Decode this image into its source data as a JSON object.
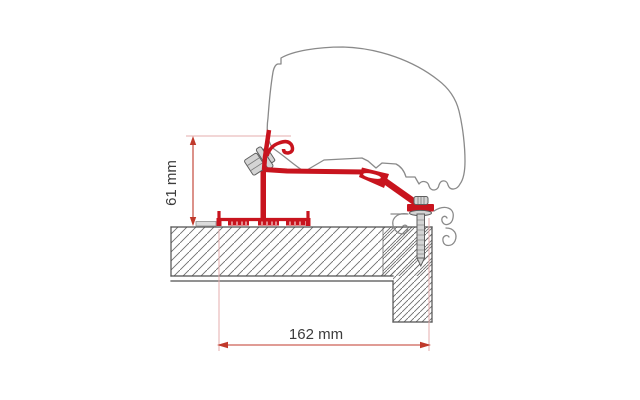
{
  "diagram": {
    "dimension_labels": {
      "height": "61 mm",
      "width": "162 mm"
    },
    "colors": {
      "adapter_red": "#c8141e",
      "dimension_line_red": "#c0392b",
      "extension_line_pink": "#e4aeae",
      "profile_outline_gray": "#8a8a8a",
      "section_outline_gray": "#4f4f4f",
      "hardware_gray": "#d4d4d4",
      "label_text": "#3c3c3c",
      "background": "#ffffff"
    }
  }
}
